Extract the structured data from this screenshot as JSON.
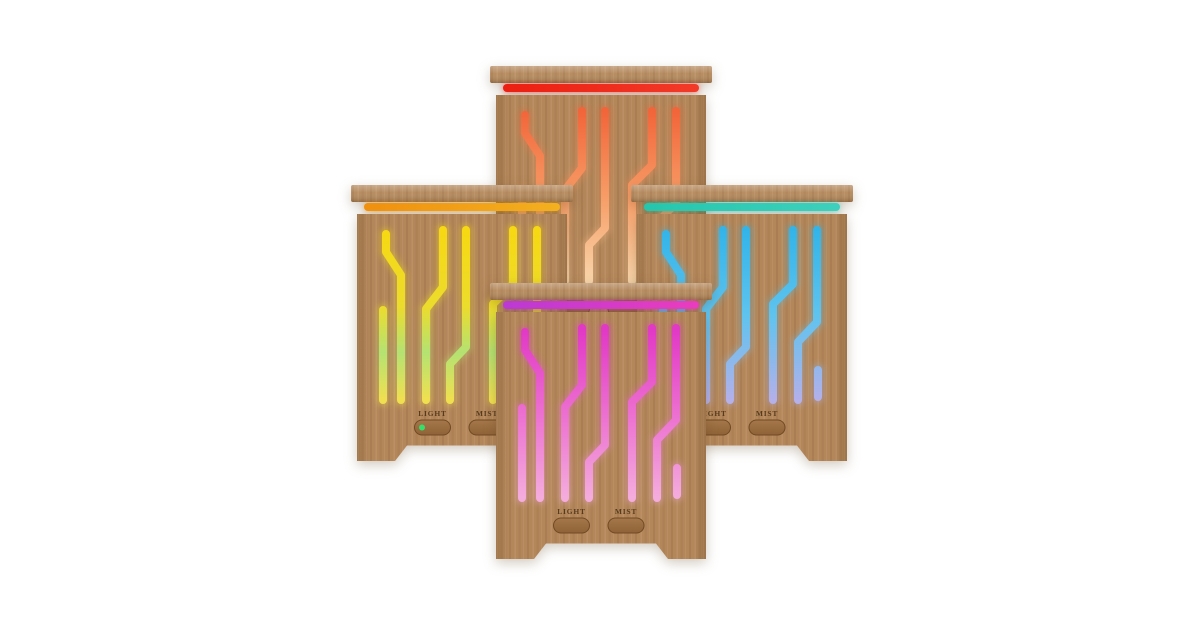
{
  "photo": {
    "alt": "Four bamboo wood aroma diffusers with colored LED circuit-trace light slits",
    "background": "#ffffff",
    "buttons": {
      "light": "LIGHT",
      "mist": "MIST"
    },
    "wood": {
      "body_base": "#b3875a",
      "grain_dark": "#a2764a",
      "grain_light": "#c2966a",
      "button_top": "#a5774a",
      "button_bottom": "#8f6337",
      "button_border": "#6f4a24",
      "label_ink": "#4a3118"
    },
    "diffusers": [
      {
        "name": "red-orange",
        "position": "back-top",
        "strip_left": "#ec1f12",
        "strip_right": "#f23a28",
        "trace_top": "#f2653a",
        "trace_mid": "#f79c66",
        "trace_bottom": "#f8d5aa"
      },
      {
        "name": "yellow",
        "position": "middle-left",
        "strip_left": "#f0900f",
        "strip_right": "#f3b01f",
        "trace_top": "#f6d813",
        "trace_mid": "#ecdc2c",
        "trace_green": "#b4e272",
        "trace_bottom": "#f0e050",
        "led_dot": "#35e06a"
      },
      {
        "name": "cyan-blue",
        "position": "middle-right",
        "strip_left": "#25c6ad",
        "strip_right": "#3ed0bc",
        "trace_top": "#33b4e9",
        "trace_mid": "#5fc3ee",
        "trace_bottom": "#b3b0ea"
      },
      {
        "name": "magenta",
        "position": "front-center",
        "strip_left": "#bb3ad3",
        "strip_right": "#ea3cbe",
        "trace_top": "#e138c5",
        "trace_mid": "#ec6fd0",
        "trace_bottom": "#f4acdd"
      }
    ]
  }
}
